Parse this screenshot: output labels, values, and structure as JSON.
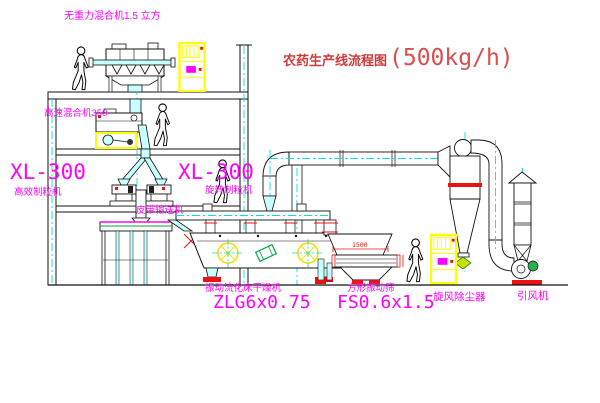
{
  "title": {
    "cn": "农药生产线流程图",
    "capacity": "(500kg/h)"
  },
  "labels": {
    "top_mixer": "无重力混合机1.5 立方",
    "high_speed_mixer": "高速混合机350",
    "granulator_left_model": "XL-300",
    "granulator_left_name": "高效制粒机",
    "granulator_right_model": "XL-300",
    "granulator_right_name": "旋转制粒机",
    "belt_conveyor": "皮带输送机",
    "dryer_name": "振动流化床干燥机",
    "dryer_model": "ZLG6x0.75",
    "screen_name": "方形振动筛",
    "screen_model": "FS0.6x1.5",
    "cyclone": "旋风除尘器",
    "fan": "引风机",
    "dim_screen": "1500"
  },
  "colors": {
    "label_magenta": "#ff00ff",
    "centerline_cyan": "#00e0e0",
    "highlight_yellow": "#ffff00",
    "accent_red": "#ee1111",
    "title_red": "#cf3b3b",
    "line_black": "#111111"
  }
}
